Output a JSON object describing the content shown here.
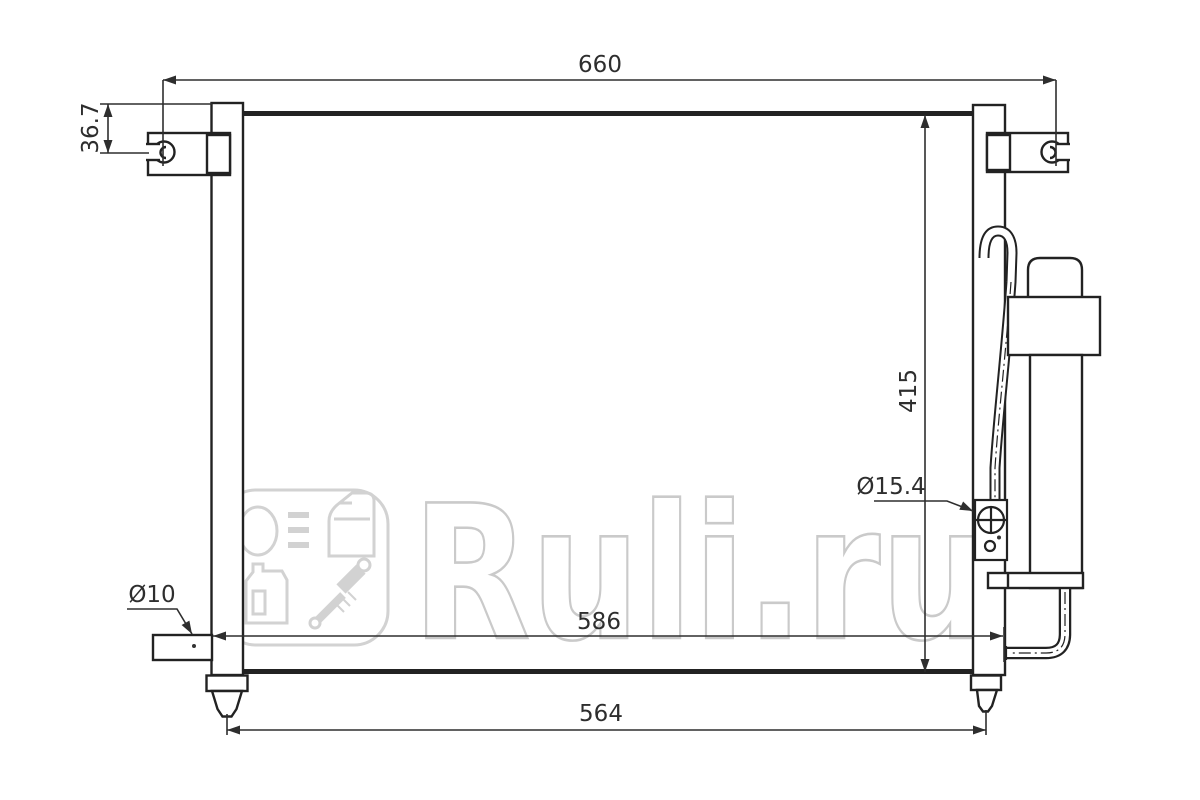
{
  "title": "Condenser technical line drawing",
  "watermark": {
    "brand": "Ruli.ru"
  },
  "dimensions": {
    "overall_width_mm": "660",
    "bracket_offset_mm": "36.7",
    "core_height_mm": "415",
    "fitting_diameter": "Ø15.4",
    "pipe_diameter": "Ø10",
    "pipe_span_mm": "586",
    "mount_span_mm": "564"
  },
  "colors": {
    "line": "#222222",
    "dim_text": "#2e2e2e",
    "watermark": "#cccccc",
    "background": "#ffffff"
  }
}
